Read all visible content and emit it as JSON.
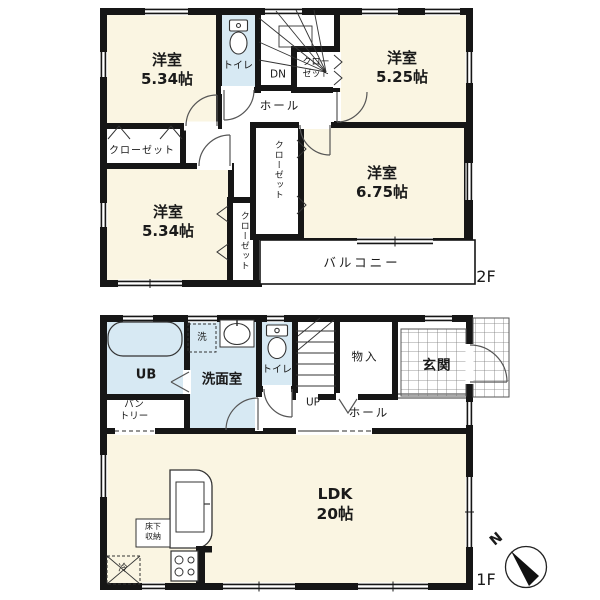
{
  "colors": {
    "wall": "#161616",
    "room_fill": "#faf5e2",
    "wet_fill": "#d7e9f3",
    "line": "#444444"
  },
  "floor2": {
    "floor_label": "2F",
    "room_a": "洋室\n5.34帖",
    "room_b": "洋室\n5.34帖",
    "room_c": "洋室\n5.25帖",
    "room_d": "洋室\n6.75帖",
    "toilet": "トイレ",
    "stairs_dn": "DN",
    "hall": "ホール",
    "closet_left": "クローゼット",
    "closet_stairs": "クロー\nゼット",
    "closet_center": "クローゼット",
    "closet_bottom": "クローゼット",
    "balcony": "バルコニー"
  },
  "floor1": {
    "floor_label": "1F",
    "unit_bath": "UB",
    "washroom": "洗面室",
    "washer": "洗",
    "toilet": "トイレ",
    "stairs_up": "UP",
    "storage": "物入",
    "hall": "ホール",
    "entrance": "玄関",
    "pantry": "パン\nトリー",
    "ldk": "LDK\n20帖",
    "floor_storage": "床下\n収納",
    "fridge": "冷"
  },
  "compass": {
    "north_label": "N"
  }
}
